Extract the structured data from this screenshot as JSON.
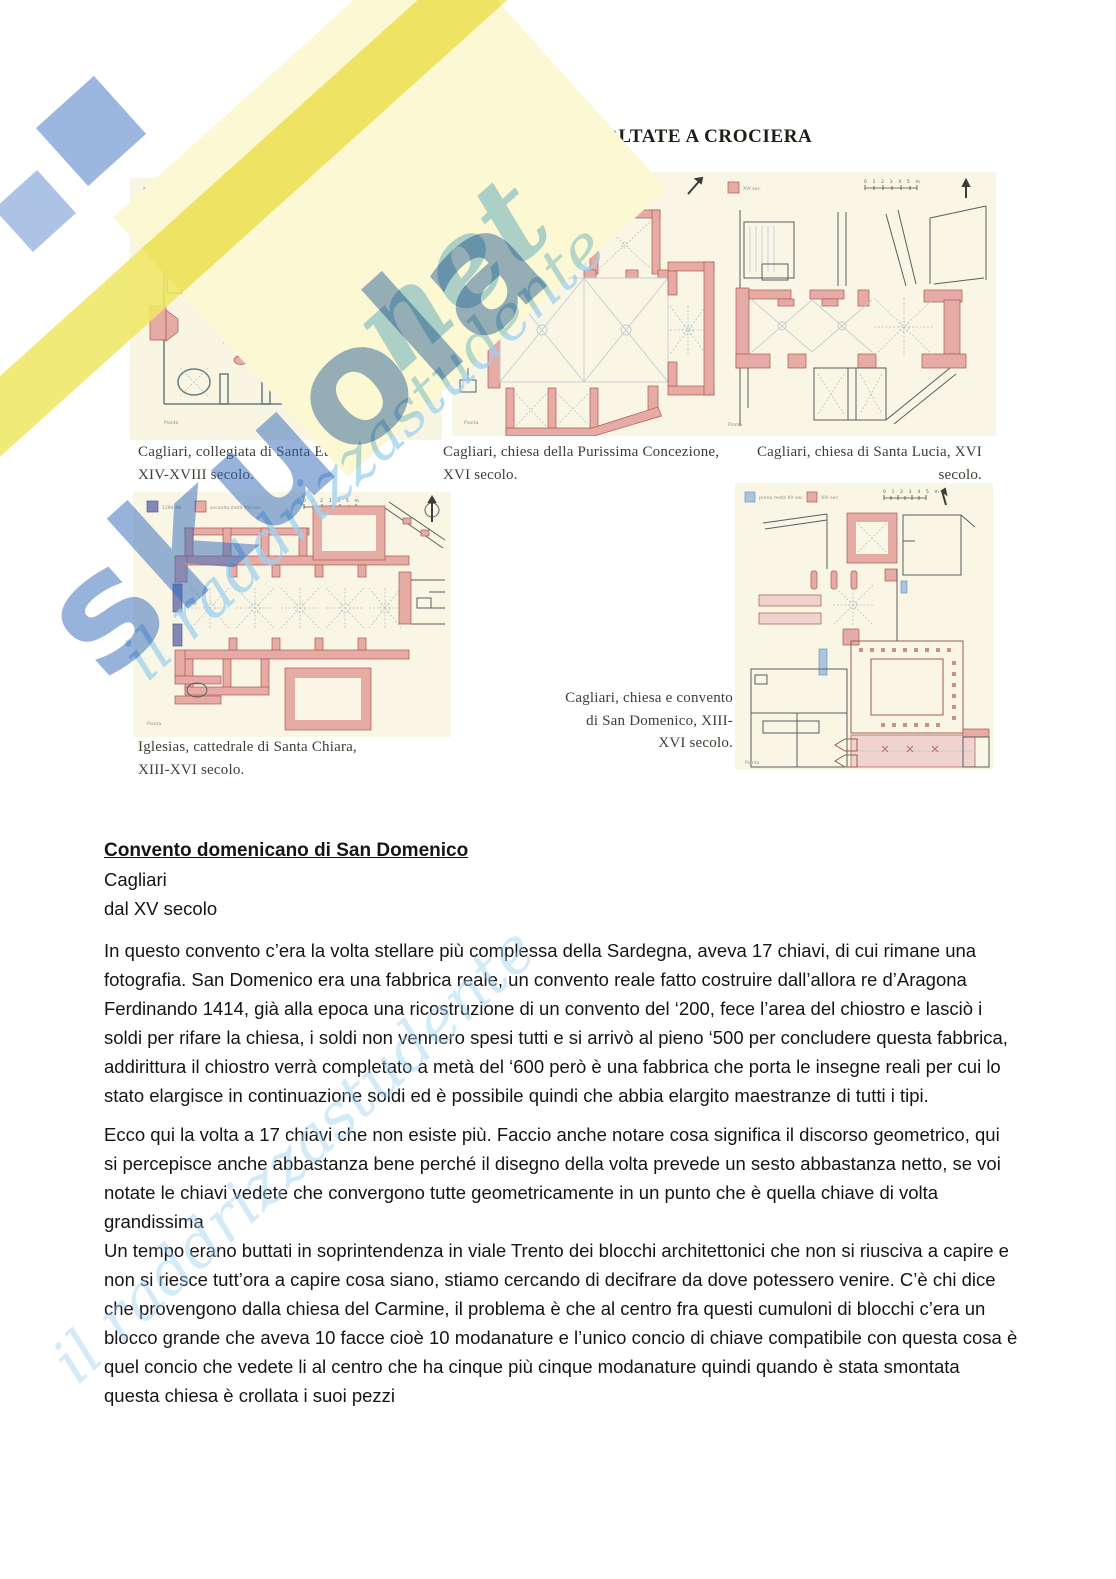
{
  "page": {
    "title": "CHIESE SARDE CON NAVATE VOLTATE A CROCIERA"
  },
  "watermark": {
    "brand": "skuola",
    "brand_suffix": "net",
    "tagline": "il raddrizzastudente",
    "blue": "#2f68ba",
    "light_blue": "#9ed1ee",
    "yellow": "#f1e765"
  },
  "figures": {
    "scale_label": "0 1 2 3 4 5 m",
    "plan_label": "Pianta",
    "plans": [
      {
        "id": "santa-eulalia",
        "caption": "Cagliari, collegiata di Santa Eulalia,\nXIV-XVIII secolo.",
        "legend": [
          {
            "color": "#e7aba6",
            "label": "ante 1275-XV sec."
          }
        ]
      },
      {
        "id": "purissima-concezione",
        "caption": "Cagliari, chiesa della Purissima Concezione,\nXVI secolo.",
        "legend": [
          {
            "color": "#e7aba6",
            "label": "prima metà XVI sec."
          }
        ]
      },
      {
        "id": "santa-lucia",
        "caption": "Cagliari, chiesa di Santa Lucia, XVI\nsecolo.",
        "legend": [
          {
            "color": "#e7aba6",
            "label": "XVI sec."
          }
        ]
      },
      {
        "id": "santa-chiara",
        "caption": "Iglesias, cattedrale di Santa Chiara,\nXIII-XVI secolo.",
        "legend": [
          {
            "color": "#8287b6",
            "label": "1284-88"
          },
          {
            "color": "#e7aba6",
            "label": "seconda metà XVI sec."
          }
        ]
      },
      {
        "id": "san-domenico",
        "caption": "Cagliari, chiesa e convento\ndi San Domenico, XIII-\nXVI secolo.",
        "legend": [
          {
            "color": "#a9c6de",
            "label": "prima metà XV sec."
          },
          {
            "color": "#e7aba6",
            "label": "XVI sec."
          }
        ]
      }
    ]
  },
  "article": {
    "heading": "Convento domenicano di San Domenico",
    "place": "Cagliari",
    "period": "dal XV secolo",
    "paragraphs": [
      "In questo convento c’era la volta stellare più complessa della Sardegna, aveva 17 chiavi, di cui rimane una fotografia. San Domenico era una fabbrica reale, un convento reale fatto costruire dall’allora re d’Aragona Ferdinando 1414, già alla epoca una ricostruzione di un convento del ‘200, fece l’area del chiostro e lasciò i soldi per rifare la chiesa, i soldi non vennero spesi tutti e si arrivò al pieno ‘500 per concludere questa fabbrica, addirittura il chiostro verrà completato a metà del ‘600 però è una fabbrica che porta le insegne reali per cui lo stato elargisce in continuazione soldi ed è possibile quindi che abbia elargito maestranze di tutti i tipi.",
      "Ecco qui la volta a 17 chiavi che non esiste più. Faccio anche notare cosa significa il discorso geometrico, qui si percepisce anche abbastanza bene perché il disegno della volta prevede un sesto abbastanza netto, se voi notate le chiavi vedete che convergono tutte geometricamente in un punto che è quella chiave di volta grandissima",
      "Un tempo erano buttati in soprintendenza in viale Trento dei blocchi architettonici che non si riusciva a capire e non si riesce tutt’ora a capire cosa siano, stiamo cercando di decifrare da dove potessero venire. C’è chi dice che provengono dalla chiesa del Carmine, il problema è che al centro fra questi cumuloni di blocchi c’era un blocco grande che aveva 10 facce cioè 10 modanature e l’unico concio di chiave compatibile con questa cosa è quel concio che vedete li al centro che ha cinque più cinque modanature quindi quando è stata smontata questa chiesa è crollata i suoi pezzi"
    ]
  }
}
